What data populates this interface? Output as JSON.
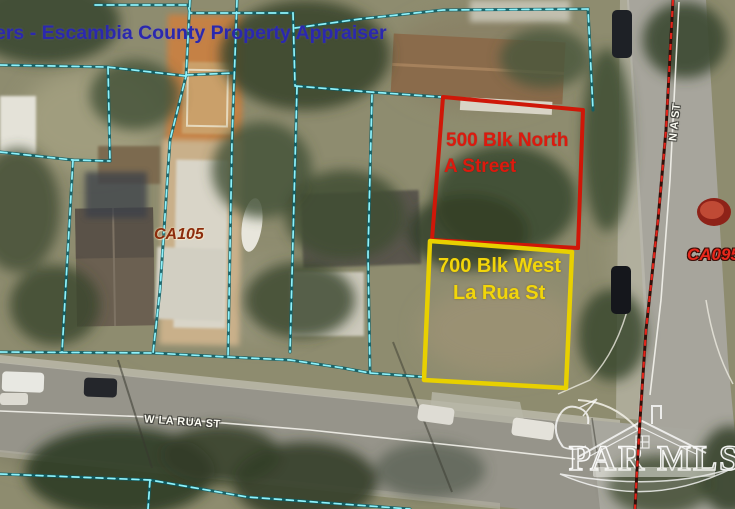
{
  "overlay": {
    "title": "ers - Escambia County Property Appraiser"
  },
  "parcels": {
    "red": {
      "line1": "500 Blk North",
      "line2": "A Street",
      "outline_color": "#cf1708",
      "label_color": "#dc1a0e"
    },
    "yellow": {
      "line1": "700 Blk West",
      "line2": "La Rua St",
      "outline_color": "#e8d000",
      "label_color": "#f2d60a"
    }
  },
  "labels": {
    "ca105": "CA105",
    "ca095": "CA095"
  },
  "streets": {
    "w_la_rua": "W LA RUA ST",
    "n_a": "N A ST"
  },
  "watermark": {
    "text": "PAR MLS"
  },
  "colors": {
    "parcel_boundary_cyan": "#8ff2fb",
    "parcel_boundary_casing": "#0f5f66",
    "district_boundary_red": "#e2241a",
    "title_blue": "#2b28ae"
  }
}
